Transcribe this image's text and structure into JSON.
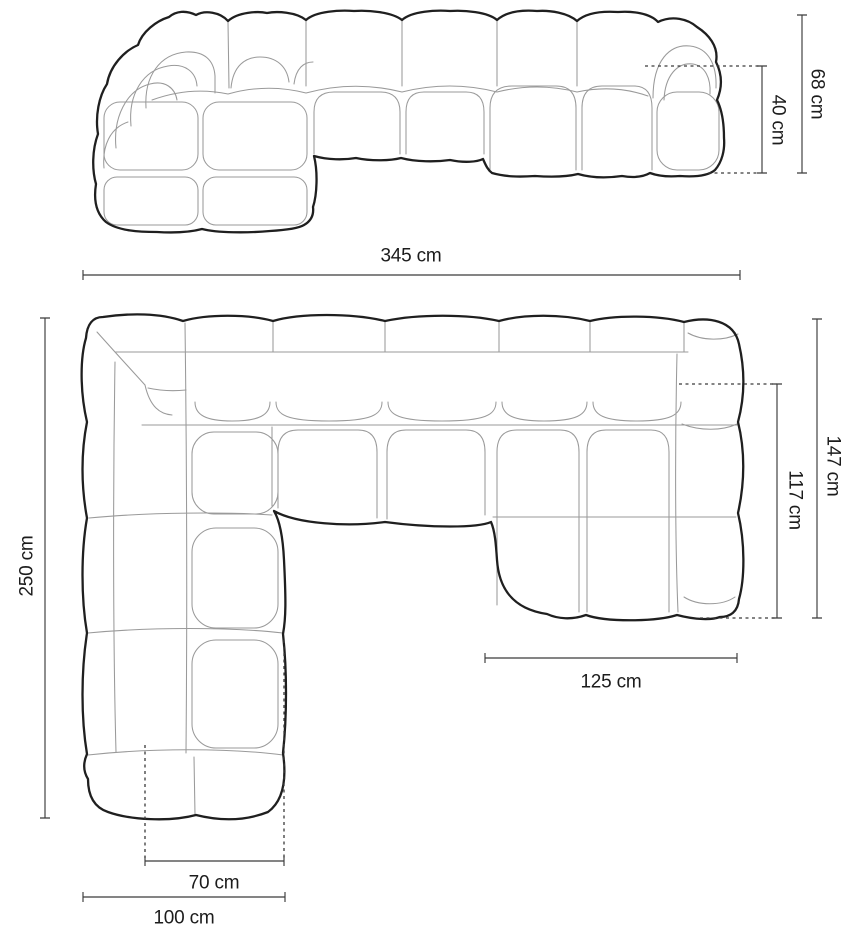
{
  "front_view": {
    "dims": {
      "total_length": "345 cm",
      "total_height": "68 cm",
      "seat_height": "40 cm"
    }
  },
  "top_view": {
    "dims": {
      "total_depth": "250 cm",
      "right_section_depth": "147 cm",
      "right_seat_depth": "117 cm",
      "right_section_width": "125 cm",
      "chaise_seat_width": "70 cm",
      "chaise_total_width": "100 cm"
    }
  },
  "colors": {
    "outline": "#1f1f1f",
    "seam": "#9a9a9a",
    "dimension": "#3a3a3a",
    "background": "#ffffff",
    "text": "#1c1c1c"
  }
}
